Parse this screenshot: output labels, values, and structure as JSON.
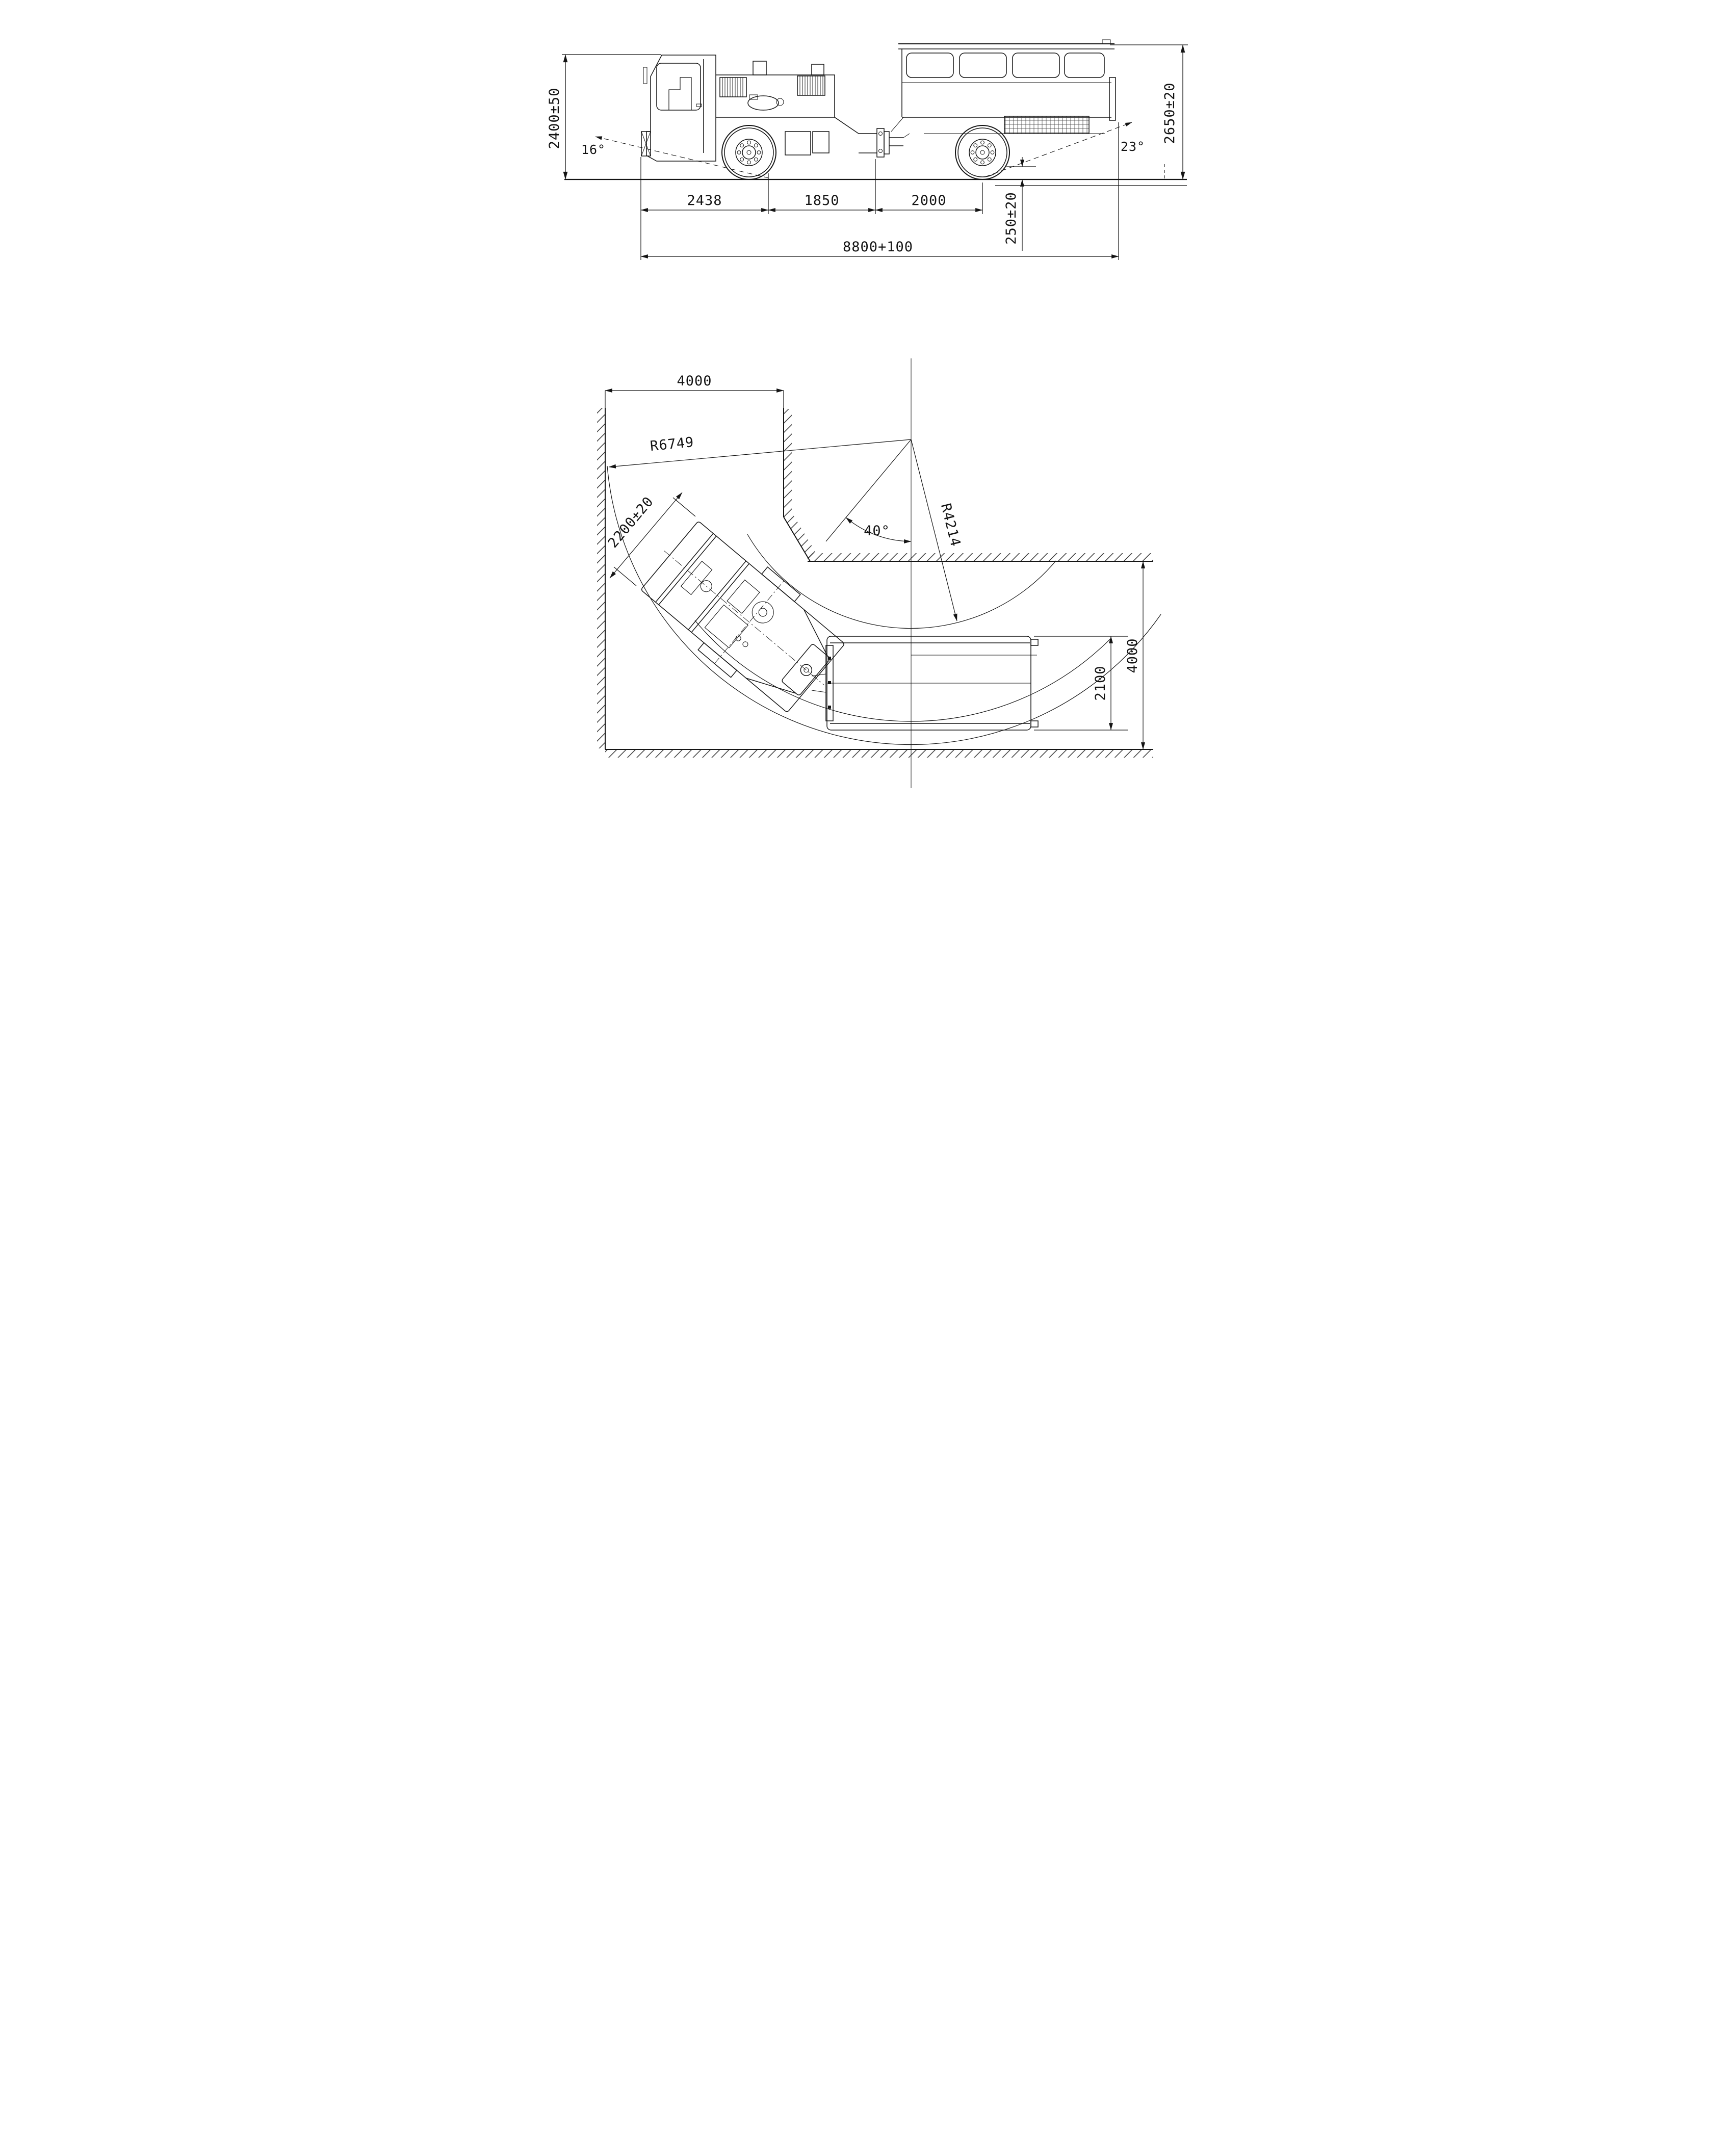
{
  "side_view": {
    "cab_height": "2400±50",
    "overall_height": "2650±20",
    "approach_angle": "16°",
    "departure_angle": "23°",
    "seg_front": "2438",
    "seg_mid": "1850",
    "seg_rear": "2000",
    "rear_deck_height": "250±20",
    "overall_length": "8800+100"
  },
  "plan_view": {
    "tunnel_width_entry": "4000",
    "outer_radius": "R6749",
    "front_unit_width": "2200±20",
    "articulation_angle": "40°",
    "inner_radius": "R4214",
    "carriage_width": "2100",
    "tunnel_width_main": "4000"
  }
}
